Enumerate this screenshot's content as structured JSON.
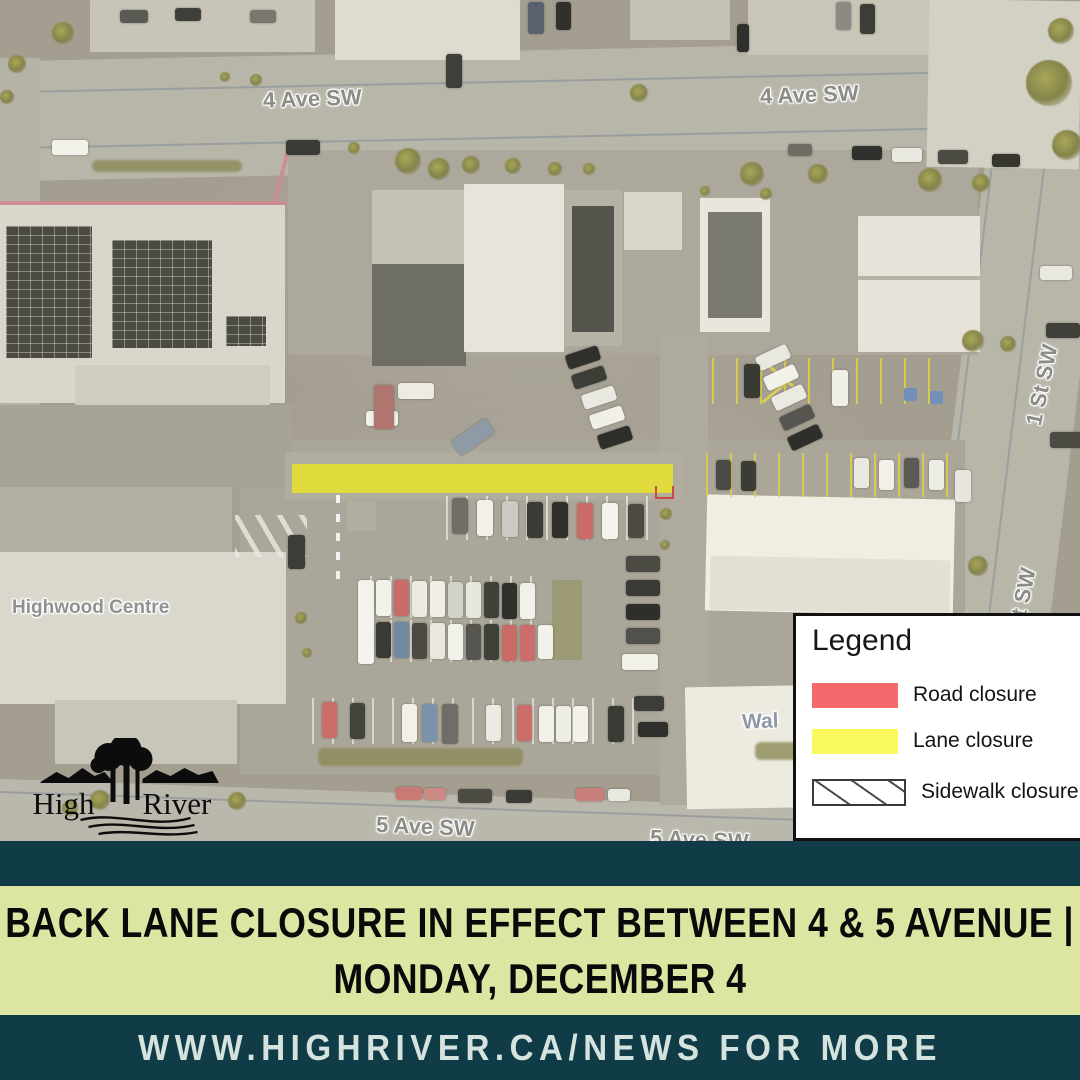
{
  "map": {
    "street_labels": {
      "ave4_left": "4 Ave SW",
      "ave4_right": "4 Ave SW",
      "st1_upper": "1 St SW",
      "st1_lower": "St SW",
      "ave5_left": "5 Ave SW",
      "ave5_right": "5 Ave SW"
    },
    "place_labels": {
      "highwood_centre": "Highwood Centre",
      "walmart_partial": "Wal"
    },
    "lane_closure_color": "#e8e32b"
  },
  "logo": {
    "word_left": "High",
    "word_right": "River"
  },
  "legend": {
    "title": "Legend",
    "items": [
      {
        "label": "Road closure",
        "color": "#f4696b",
        "style": "solid"
      },
      {
        "label": "Lane closure",
        "color": "#f9f95d",
        "style": "solid"
      },
      {
        "label": "Sidewalk closure",
        "color": "#ffffff",
        "style": "hatched"
      }
    ]
  },
  "banner": {
    "line1": "BACK LANE CLOSURE IN EFFECT BETWEEN 4 & 5 AVENUE |",
    "line2": "MONDAY, DECEMBER 4"
  },
  "footer": {
    "text": "WWW.HIGHRIVER.CA/NEWS FOR MORE"
  },
  "colors": {
    "teal_band": "#0f3c46",
    "green_band": "#dce5a2",
    "footer_text": "#d5e3df"
  }
}
